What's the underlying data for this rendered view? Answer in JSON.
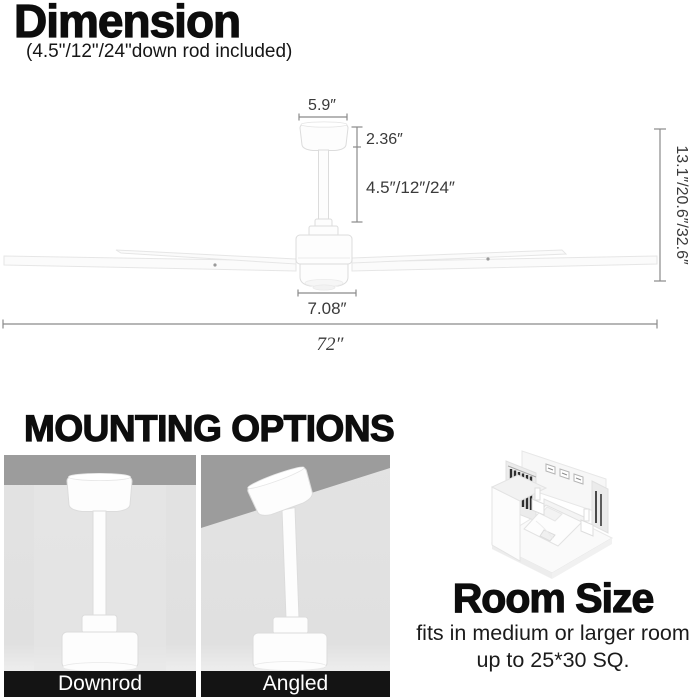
{
  "dimension": {
    "title": "Dimension",
    "subtitle": "(4.5\"/12\"/24\"down rod included)",
    "labels": {
      "canopy_width": "5.9″",
      "canopy_height": "2.36″",
      "downrod_length": "4.5″/12″/24″",
      "motor_width": "7.08″",
      "blade_span": "72″",
      "overall_height": "13.1″/20.6″/32.6″"
    }
  },
  "mounting": {
    "title": "MOUNTING OPTIONS",
    "options": [
      {
        "label": "Downrod"
      },
      {
        "label": "Angled"
      }
    ]
  },
  "room": {
    "title": "Room Size",
    "line1": "fits in medium or larger room",
    "line2": "up to 25*30 SQ."
  },
  "colors": {
    "heading_text": "#0d0d0d",
    "dimension_lines": "#8a8a8a",
    "dimension_text": "#3a3a3a",
    "fan_body": "#fdfdfd",
    "fan_outline": "#dcdcdc",
    "ceiling_gray": "#9c9c9c",
    "wall_gray": "#e2e2e2",
    "label_bar": "#141414",
    "label_text": "#ffffff"
  }
}
